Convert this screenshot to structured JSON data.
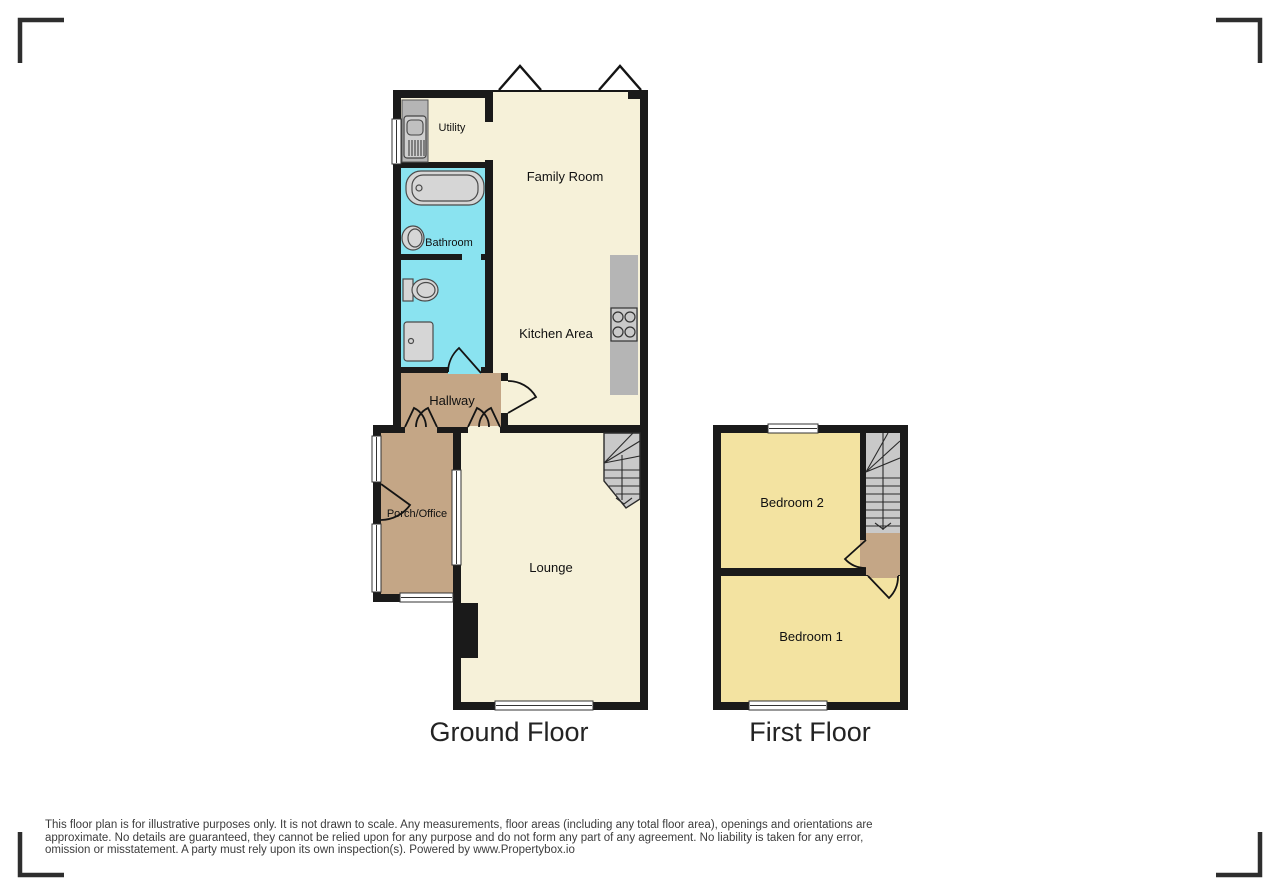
{
  "colors": {
    "wall": "#1a1a1a",
    "cream": "#f6f1d9",
    "cyan": "#8ae3f0",
    "tan": "#c4a686",
    "yellow": "#f3e3a1",
    "stairs": "#c9c9c9",
    "counter": "#b5b5b5",
    "window": "#ffffff"
  },
  "floors": [
    {
      "title": "Ground Floor",
      "rooms": [
        {
          "name": "Utility"
        },
        {
          "name": "Family Room"
        },
        {
          "name": "Bathroom"
        },
        {
          "name": "Kitchen Area"
        },
        {
          "name": "Hallway"
        },
        {
          "name": "Porch/Office"
        },
        {
          "name": "Lounge"
        }
      ],
      "fixtures": [
        "washing-machine",
        "bathtub",
        "wash-basin",
        "toilet",
        "shower-tray",
        "hob",
        "staircase",
        "chimney-breast"
      ]
    },
    {
      "title": "First Floor",
      "rooms": [
        {
          "name": "Bedroom 2"
        },
        {
          "name": "Bedroom 1"
        }
      ],
      "fixtures": [
        "staircase",
        "landing"
      ]
    }
  ],
  "disclaimer": {
    "lines": [
      "This floor plan is for illustrative purposes only. It is not drawn to scale. Any measurements, floor areas (including any total floor area), openings and orientations are",
      "approximate. No details are guaranteed, they cannot be relied upon for any purpose and do not form any part of any agreement. No liability is taken for any error,",
      "omission or misstatement. A party must rely upon its own inspection(s). Powered by www.Propertybox.io"
    ]
  }
}
